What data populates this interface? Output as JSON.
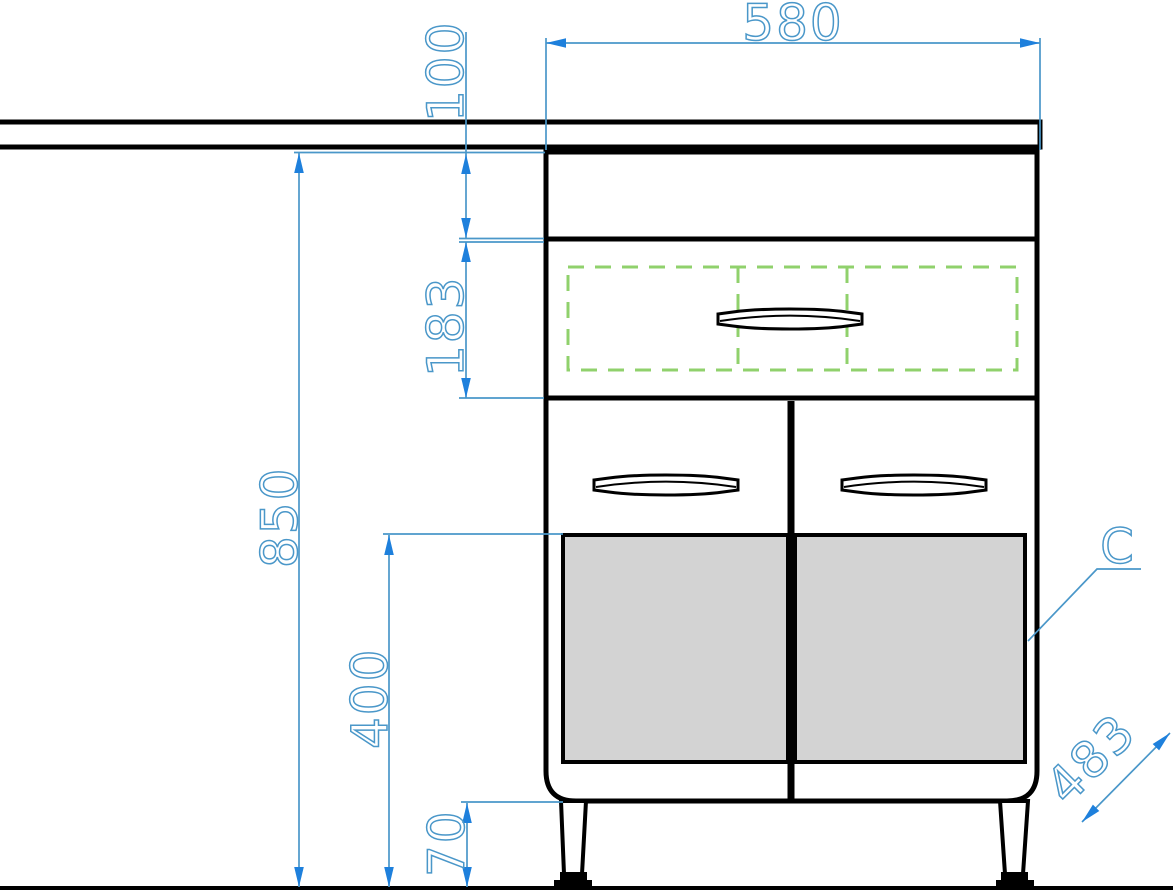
{
  "drawing": {
    "type": "furniture-front-elevation",
    "labels": {
      "section_c": "C"
    },
    "dimensions": {
      "cabinet_width": "580",
      "top_section_height": "100",
      "drawer_front_height": "183",
      "overall_height": "850",
      "panel_to_floor_height": "400",
      "leg_clearance": "70",
      "depth": "483"
    },
    "colors": {
      "dimension_blue": "#4a97c9",
      "arrow_blue": "#1e80dc",
      "dashed_green": "#90d16c",
      "panel_gray": "#d3d3d3",
      "line_black": "#000000"
    }
  }
}
